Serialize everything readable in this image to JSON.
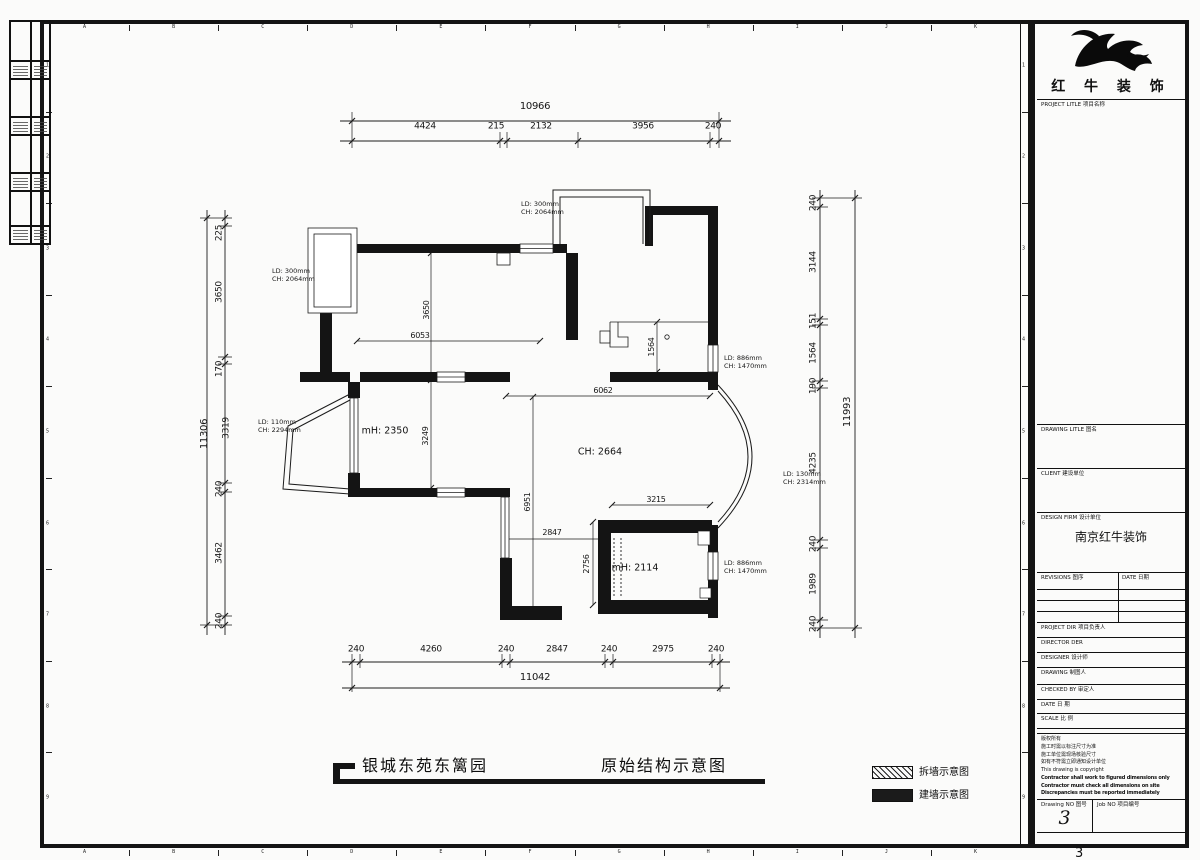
{
  "frame": {
    "grid_letters": [
      "A",
      "B",
      "C",
      "D",
      "E",
      "F",
      "G",
      "H",
      "I",
      "J",
      "K"
    ],
    "grid_numbers": [
      "1",
      "2",
      "3",
      "4",
      "5",
      "6",
      "7",
      "8",
      "9"
    ],
    "page_number": "3"
  },
  "title_block": {
    "logo_name": "红 牛 装 饰",
    "project_title_label": "PROJECT LITLE 项目名称",
    "drawing_title_label": "DRAWING LITLE 图名",
    "client_label": "CLIENT 建设单位",
    "design_firm_label": "DESIGN FIRM 设计单位",
    "design_firm_value": "南京红牛装饰",
    "revisions_label": "REVISIONS 图序",
    "date_col_label": "DATE 日期",
    "project_dir_label": "PROJECT DIR 项目负责人",
    "director_label": "DIRECTOR DER",
    "designer_label": "DESIGNER 设计师",
    "drawing_label": "DRAWING 制图人",
    "checked_by_label": "CHECKED BY 审定人",
    "date_label": "DATE 日 期",
    "scale_label": "SCALE 比 例",
    "copyright_lines": [
      "版权所有",
      "施工时需以标注尺寸为准",
      "施工单位需现场核验尺寸",
      "如有不符需立即通知设计单位",
      "This drawing is copyright",
      "Contractor shall work to figured dimensions only",
      "Contractor must check all dimensions on site",
      "Discrepancies must be reported immediately"
    ],
    "drawing_no_label": "Drawing NO 图号",
    "drawing_no_value": "3",
    "job_no_label": "Job NO 项目编号"
  },
  "footer": {
    "project_name": "银城东苑东篱园",
    "drawing_name": "原始结构示意图",
    "legend_demolish": "拆墙示意图",
    "legend_build": "建墙示意图"
  },
  "plan": {
    "dim_top": {
      "total": "10966",
      "segs": [
        "4424",
        "215",
        "2132",
        "3956",
        "240"
      ]
    },
    "dim_bottom": {
      "total": "11042",
      "segs": [
        "240",
        "4260",
        "240",
        "2847",
        "240",
        "2975",
        "240"
      ]
    },
    "dim_left": {
      "total": "11306",
      "segs": [
        "225",
        "3650",
        "170",
        "3319",
        "240",
        "3462",
        "240"
      ]
    },
    "dim_right": {
      "total": "11993",
      "segs": [
        "240",
        "3144",
        "151",
        "1564",
        "190",
        "4235",
        "240",
        "1989",
        "240"
      ]
    },
    "interior": {
      "room_tl_h": "3650",
      "room_tl_w": "6053",
      "kitchen_w": "1564",
      "hall_w": "6062",
      "room_ml_h": "3249",
      "hall_h": "6951",
      "entry_w": "2847",
      "dining_w": "3215",
      "bath_h": "2756"
    },
    "rooms": {
      "room_ml": "mH: 2350",
      "hall": "CH: 2664",
      "bath": "mH: 2114"
    },
    "openings": [
      {
        "l1": "LD: 300mm",
        "l2": "CH: 2064mm"
      },
      {
        "l1": "LD: 300mm",
        "l2": "CH: 2064mm"
      },
      {
        "l1": "LD: 110mm",
        "l2": "CH: 2294mm"
      },
      {
        "l1": "LD: 886mm",
        "l2": "CH: 1470mm"
      },
      {
        "l1": "LD: 130mm",
        "l2": "CH: 2314mm"
      },
      {
        "l1": "LD: 886mm",
        "l2": "CH: 1470mm"
      }
    ]
  },
  "colors": {
    "line": "#1c1c1c",
    "wall": "#141414",
    "paper": "#fbfbfa"
  }
}
